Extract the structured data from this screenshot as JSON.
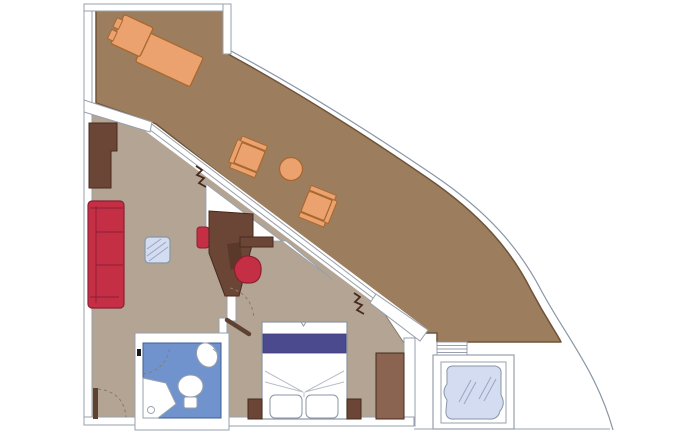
{
  "document": {
    "type": "floor-plan",
    "subject": "suite-with-wraparound-terrace",
    "view": "top-down",
    "visible_text": []
  },
  "canvas": {
    "width": 700,
    "height": 433
  },
  "palette": {
    "terraceFloor": "#9c7d5e",
    "terraceEdge": "#6f5339",
    "interiorFloor": "#b3a494",
    "interiorEdge": "#8a7a68",
    "wall": "#ffffff",
    "line": "#97a0ac",
    "glassLine": "#8896a6",
    "orange": "#eba26e",
    "orangeEdge": "#a9682f",
    "red": "#c52f46",
    "redEdge": "#8c1f31",
    "woodDark": "#6b4536",
    "woodDarkEdge": "#472a1d",
    "woodMid": "#8a6450",
    "doorLeaf": "#5e4130",
    "bedRunner": "#4c4a8e",
    "bedRunnerEdge": "#3e3c7a",
    "bathFloor": "#7093cd",
    "bathFloorEdge": "#3f5c92",
    "glassBlue": "#d3dcf0",
    "glassHatch": "#9aa6c0",
    "foldLine": "#b9bec7",
    "hinge": "#1a1a1a",
    "arcDash": "#8a7a68"
  },
  "rooms": [
    {
      "name": "terrace"
    },
    {
      "name": "living-area"
    },
    {
      "name": "bedroom"
    },
    {
      "name": "bathroom"
    },
    {
      "name": "whirlpool-deck"
    }
  ],
  "furniture": {
    "terrace": [
      "sun-lounger",
      "armchair",
      "round-side-table",
      "armchair"
    ],
    "living_area": [
      "tv-cabinet",
      "sofa",
      "glass-coffee-table",
      "desk",
      "desk-chair",
      "wall-shelf",
      "stool"
    ],
    "bedroom": [
      "double-bed",
      "bed-runner",
      "pillow",
      "pillow",
      "nightstand",
      "nightstand",
      "wardrobe"
    ],
    "bathroom": [
      "washbasin",
      "toilet",
      "shower"
    ],
    "whirlpool_deck": [
      "whirlpool-tub",
      "steps"
    ]
  },
  "symbols": [
    "door-swing-arc",
    "door-leaf",
    "sliding-door-zigzag",
    "hinge-mark",
    "hull-railing-curve",
    "window-wall-double-line"
  ]
}
